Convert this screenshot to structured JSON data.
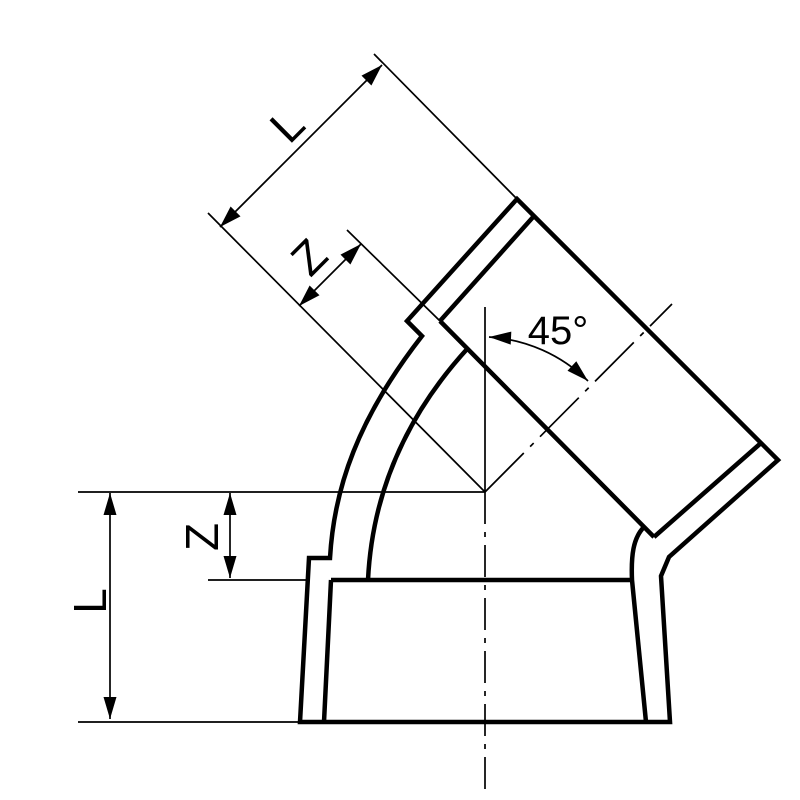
{
  "drawing": {
    "title": "45-degree elbow pipe fitting - dimensional technical drawing",
    "angle": {
      "label": "45°"
    },
    "dimensions": {
      "diagonal_socket_length": {
        "label": "L"
      },
      "diagonal_socket_engagement": {
        "label": "Z"
      },
      "bottom_socket_length": {
        "label": "L"
      },
      "bottom_socket_engagement": {
        "label": "Z"
      }
    },
    "colors": {
      "line": "#000000",
      "background": "#ffffff"
    }
  }
}
